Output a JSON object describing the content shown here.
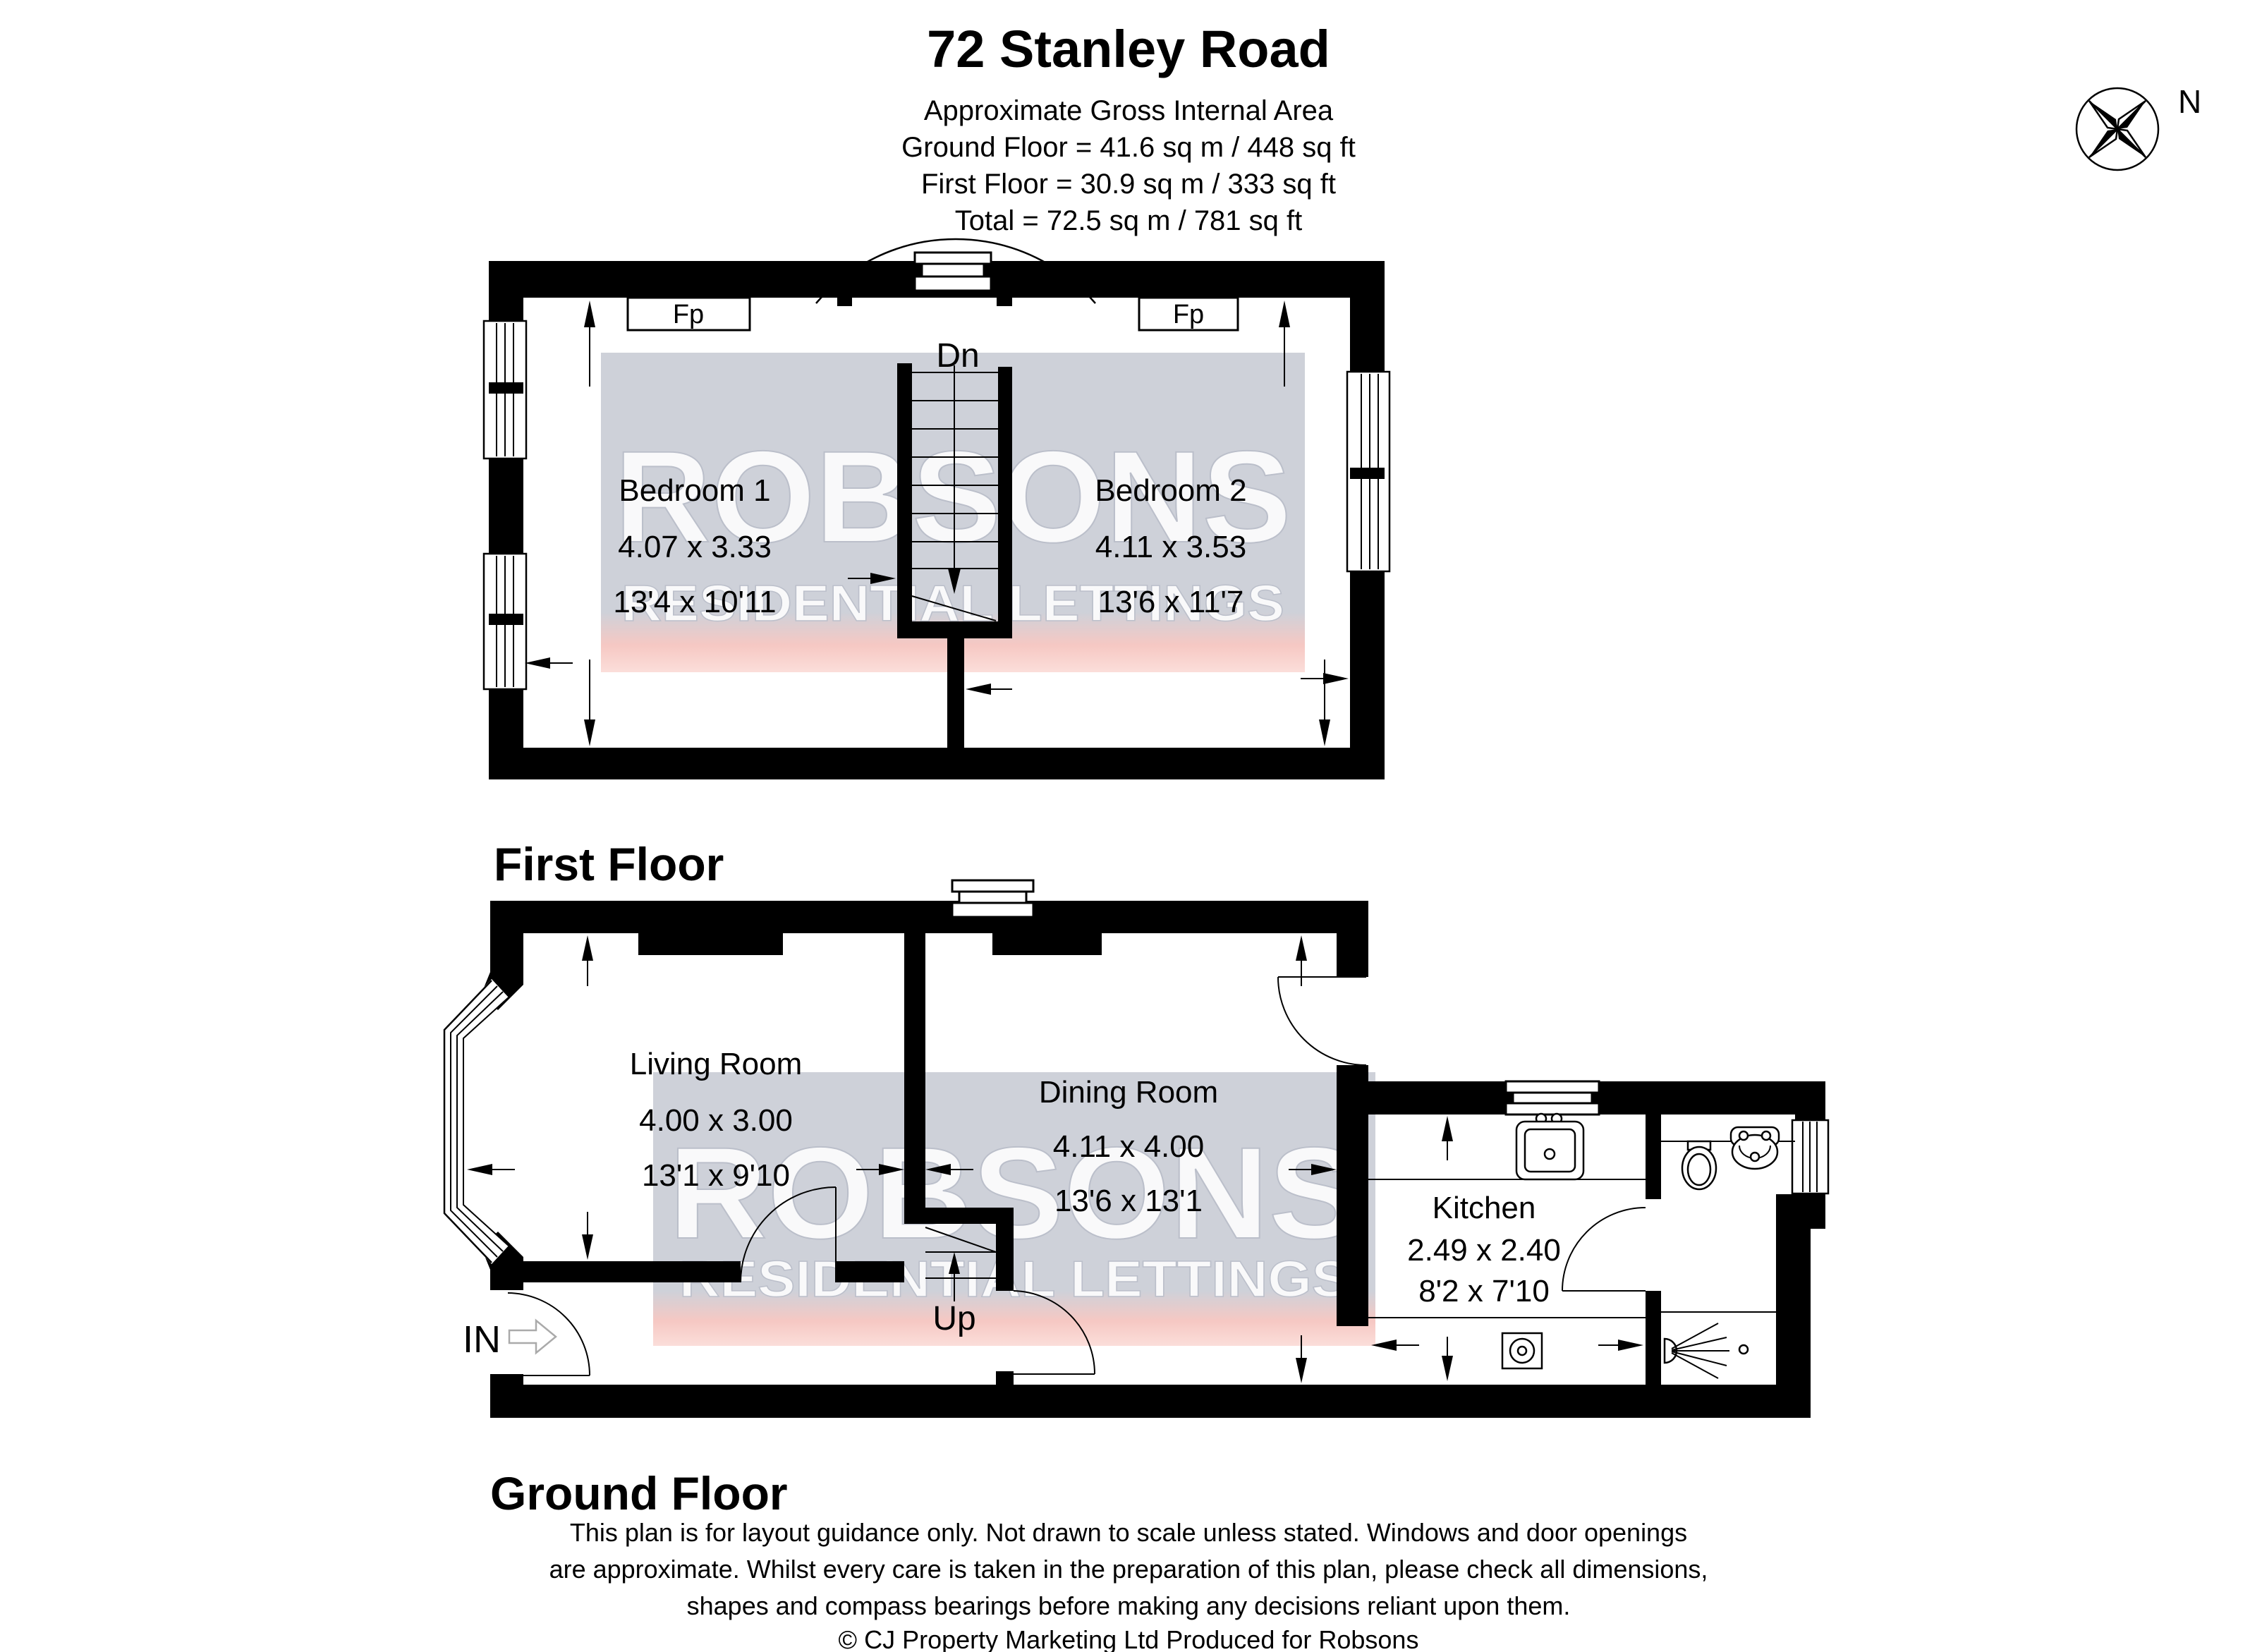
{
  "header": {
    "title": "72 Stanley Road",
    "subtitle": "Approximate Gross Internal Area",
    "area_lines": [
      "Ground Floor = 41.6 sq m / 448 sq ft",
      "First Floor = 30.9 sq m / 333 sq ft",
      "Total = 72.5 sq m / 781 sq ft"
    ],
    "compass_label": "N"
  },
  "first_floor": {
    "label": "First Floor",
    "fireplace_label": "Fp",
    "stairs_label": "Dn",
    "rooms": [
      {
        "name": "Bedroom 1",
        "metric": "4.07 x 3.33",
        "imperial": "13'4 x 10'11"
      },
      {
        "name": "Bedroom 2",
        "metric": "4.11 x 3.53",
        "imperial": "13'6 x 11'7"
      }
    ]
  },
  "ground_floor": {
    "label": "Ground Floor",
    "stairs_label": "Up",
    "entrance_label": "IN",
    "rooms": [
      {
        "name": "Living Room",
        "metric": "4.00 x 3.00",
        "imperial": "13'1 x 9'10"
      },
      {
        "name": "Dining Room",
        "metric": "4.11 x 4.00",
        "imperial": "13'6 x 13'1"
      },
      {
        "name": "Kitchen",
        "metric": "2.49 x 2.40",
        "imperial": "8'2 x 7'10"
      }
    ]
  },
  "watermark": {
    "brand": "ROBSONS",
    "tagline": "RESIDENTIAL LETTINGS"
  },
  "colors": {
    "wall": "#000000",
    "watermark_gray": "#ced1d9",
    "watermark_pink": "#f6c8c3"
  },
  "footer": {
    "disclaimer_lines": [
      "This plan is for layout guidance only. Not drawn to scale unless stated. Windows and door openings",
      "are approximate. Whilst every care is taken in the preparation of this plan, please check all dimensions,",
      "shapes and compass bearings before making any decisions reliant upon them."
    ],
    "copyright": "© CJ Property Marketing Ltd Produced for Robsons"
  }
}
